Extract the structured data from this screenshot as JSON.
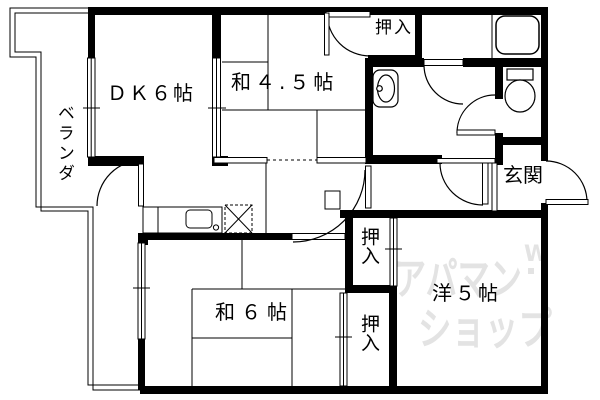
{
  "plan": {
    "background": "#ffffff",
    "line_color": "#000000",
    "watermark_color": "#e3e3e3"
  },
  "rooms": {
    "dk": {
      "label": "ＤＫ６帖"
    },
    "washitsu45": {
      "label": "和４.５帖"
    },
    "washitsu6": {
      "label": "和６帖"
    },
    "youshitsu5": {
      "label": "洋５帖"
    },
    "genkan": {
      "label": "玄関"
    },
    "veranda": {
      "label": "ベランダ"
    },
    "closet_top": {
      "label": "押入"
    },
    "closet_middle": {
      "label": "押入"
    },
    "closet_bottom": {
      "label": "押入"
    }
  },
  "fixtures": [
    "bathtub-icon",
    "toilet-icon",
    "washbasin-icon",
    "kitchen-sink-icon",
    "washing-machine-space-icon"
  ],
  "watermark": {
    "line1": "アパマン",
    "line2": "ショップ",
    "mark": "W"
  }
}
